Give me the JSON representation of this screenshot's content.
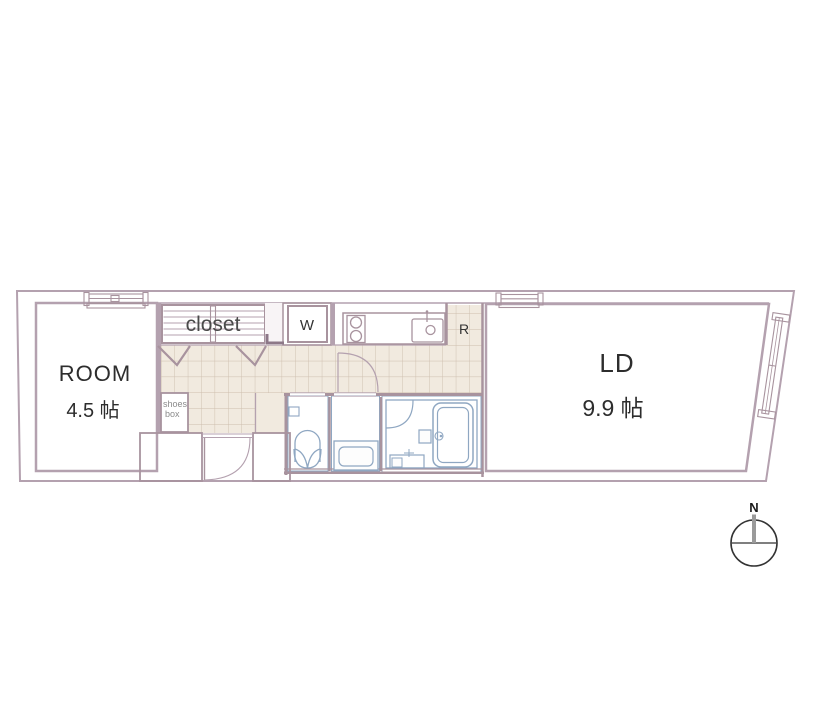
{
  "floor_plan": {
    "room": {
      "label": "ROOM",
      "size": "4.5 帖"
    },
    "ld": {
      "label": "LD",
      "size": "9.9 帖"
    },
    "closet": {
      "label": "closet"
    },
    "shoes_box": {
      "line1": "shoes",
      "line2": "box"
    },
    "fixtures": {
      "washing_machine": "W",
      "refrigerator": "R"
    },
    "compass": {
      "north": "N"
    },
    "colors": {
      "outer_fill": "#f7f3f5",
      "floor_beige": "#f1eadf",
      "closet_orange": "#fce3b5",
      "water_blue": "#dcebf8",
      "water_line": "#8fa7c2",
      "wall_line": "#a8939e",
      "grid_line": "#cdbdad",
      "text_dark": "#2d2d2d"
    }
  }
}
